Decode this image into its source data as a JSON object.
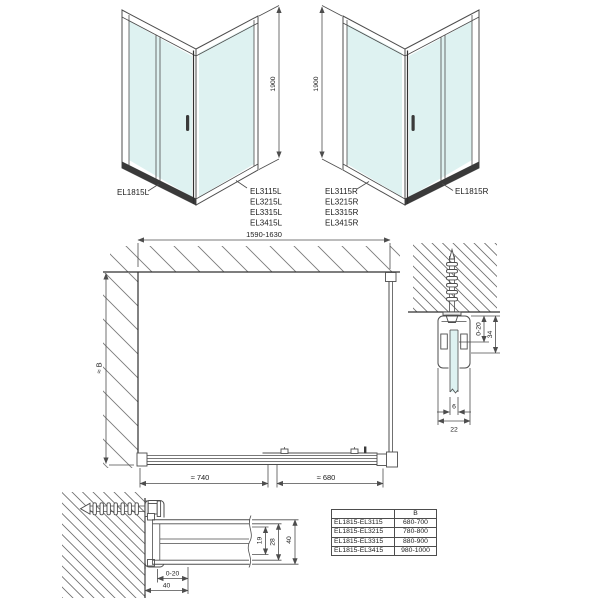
{
  "iso_left": {
    "door_label": "EL1815L",
    "panel_labels": [
      "EL3115L",
      "EL3215L",
      "EL3315L",
      "EL3415L"
    ],
    "height_dim": "1900"
  },
  "iso_right": {
    "door_label": "EL1815R",
    "panel_labels": [
      "EL3115R",
      "EL3215R",
      "EL3315R",
      "EL3415R"
    ],
    "height_dim": "1900"
  },
  "plan": {
    "width_range": "1590-1630",
    "depth_dim": "≈ B",
    "bottom_left_dim": "≈ 740",
    "bottom_right_dim": "≈ 680"
  },
  "wall_profile_section_vertical": {
    "glass_adjust_range": "0-20",
    "profile_height": "34",
    "glass_thickness": "6",
    "profile_width": "22"
  },
  "wall_profile_section_horizontal": {
    "door_adjust_range": "0-20",
    "profile_width_bottom": "40",
    "inner_depth": "19",
    "mid_depth": "28",
    "outer_depth": "40"
  },
  "size_table": {
    "col_headers": [
      "",
      "B"
    ],
    "rows": [
      {
        "models": "EL1815-EL3115",
        "b": "680-700"
      },
      {
        "models": "EL1815-EL3215",
        "b": "780-800"
      },
      {
        "models": "EL1815-EL3315",
        "b": "880-900"
      },
      {
        "models": "EL1815-EL3415",
        "b": "980-1000"
      }
    ]
  },
  "colors": {
    "glass": "#def2f1",
    "line": "#4d4d4d",
    "dark_profile": "#3a3a3a",
    "hatch": "#7a7a7a"
  }
}
